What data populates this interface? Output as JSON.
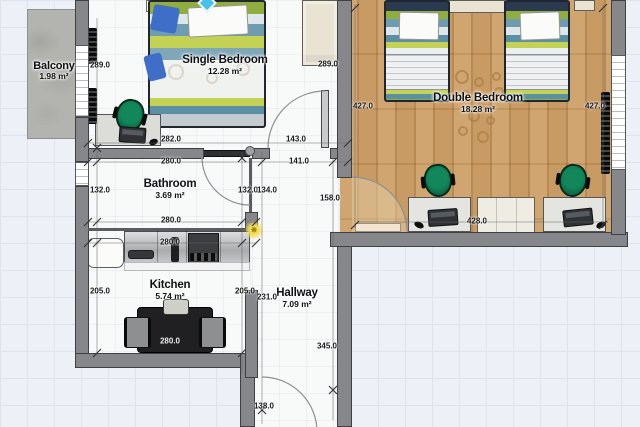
{
  "plan": {
    "title": "Apartment floor plan",
    "rooms": [
      {
        "name": "Balcony",
        "area": "1.98 m²"
      },
      {
        "name": "Single Bedroom",
        "area": "12.28 m²"
      },
      {
        "name": "Double Bedroom",
        "area": "18.28 m²"
      },
      {
        "name": "Bathroom",
        "area": "3.69 m²"
      },
      {
        "name": "Kitchen",
        "area": "5.74 m²"
      },
      {
        "name": "Hallway",
        "area": "7.09 m²"
      }
    ],
    "dimensions": [
      {
        "label": "289.0",
        "x": 100,
        "y": 65
      },
      {
        "label": "289.0",
        "x": 328,
        "y": 64
      },
      {
        "label": "282.0",
        "x": 171,
        "y": 139
      },
      {
        "label": "143.0",
        "x": 296,
        "y": 139
      },
      {
        "label": "280.0",
        "x": 171,
        "y": 161
      },
      {
        "label": "141.0",
        "x": 299,
        "y": 161
      },
      {
        "label": "132.0",
        "x": 100,
        "y": 190
      },
      {
        "label": "132.0",
        "x": 248,
        "y": 190
      },
      {
        "label": "134.0",
        "x": 267,
        "y": 190
      },
      {
        "label": "158.0",
        "x": 330,
        "y": 198
      },
      {
        "label": "280.0",
        "x": 171,
        "y": 220
      },
      {
        "label": "280.0",
        "x": 170,
        "y": 242
      },
      {
        "label": "205.0",
        "x": 100,
        "y": 291
      },
      {
        "label": "205.0",
        "x": 245,
        "y": 291
      },
      {
        "label": "231.0",
        "x": 267,
        "y": 297
      },
      {
        "label": "345.0",
        "x": 327,
        "y": 346
      },
      {
        "label": "138.0",
        "x": 264,
        "y": 406
      },
      {
        "label": "427.0",
        "x": 363,
        "y": 106
      },
      {
        "label": "427.0",
        "x": 595,
        "y": 106
      },
      {
        "label": "428.0",
        "x": 477,
        "y": 221
      },
      {
        "label": "280.0",
        "x": 170,
        "y": 341,
        "light": true
      }
    ],
    "colors": {
      "wall": "#85878b",
      "wood_floor": "#c6965c",
      "room_floor": "#f8f9f9",
      "balcony_floor": "#b3b4b0",
      "chair_green": "#0f7a52",
      "grid_background": "#edf0f6",
      "bed_stripe_green": "#8fae3e",
      "bed_stripe_teal": "#6f9cb0"
    }
  }
}
